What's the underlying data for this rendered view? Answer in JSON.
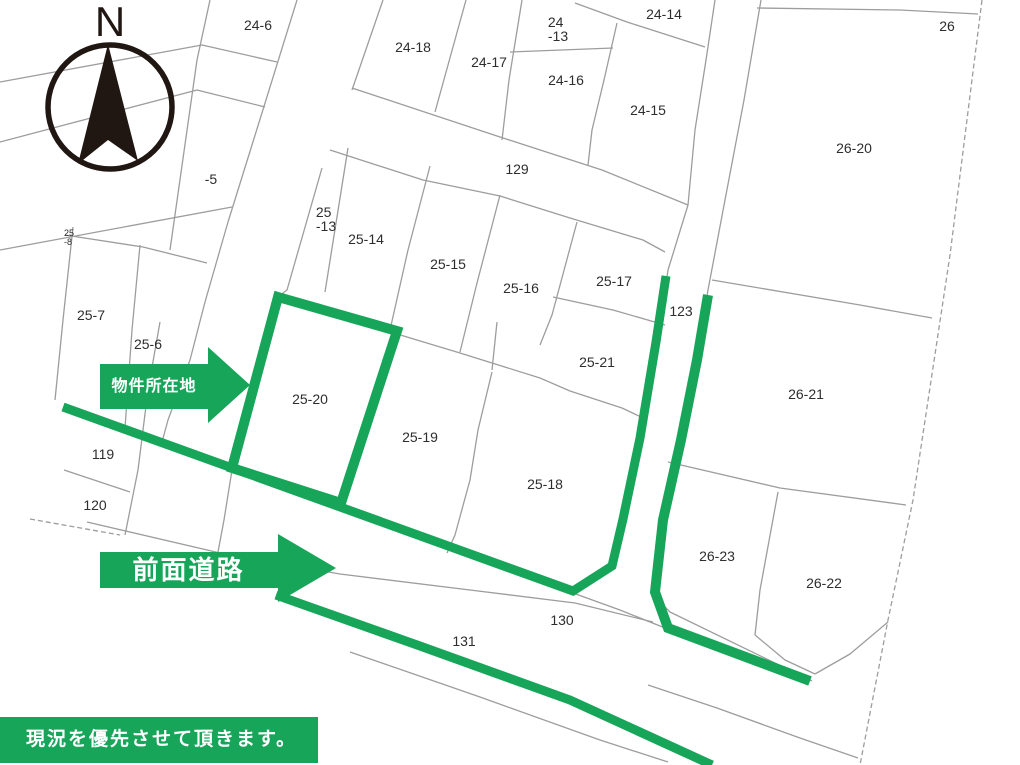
{
  "colors": {
    "highlight_green": "#17a559",
    "line_gray": "#9d9d9d",
    "label_color": "#2e2e2e",
    "compass_dark": "#201612",
    "background": "#ffffff",
    "annotation_text": "#ffffff"
  },
  "compass": {
    "label": "N"
  },
  "annotations": {
    "property_location": "物件所在地",
    "front_road": "前面道路",
    "note": "現況を優先させて頂きます。"
  },
  "parcel_labels": [
    {
      "t": "24-6",
      "x": 258,
      "y": 25
    },
    {
      "t": "24-14",
      "x": 664,
      "y": 14
    },
    {
      "t": "24\n-13",
      "x": 558,
      "y": 29,
      "align": "left"
    },
    {
      "t": "24-18",
      "x": 413,
      "y": 47
    },
    {
      "t": "24-17",
      "x": 489,
      "y": 62
    },
    {
      "t": "24-16",
      "x": 566,
      "y": 80
    },
    {
      "t": "24-15",
      "x": 648,
      "y": 110
    },
    {
      "t": "26",
      "x": 947,
      "y": 26
    },
    {
      "t": "129",
      "x": 517,
      "y": 169
    },
    {
      "t": "26-20",
      "x": 854,
      "y": 148
    },
    {
      "t": "-5",
      "x": 211,
      "y": 179
    },
    {
      "t": "25\n-13",
      "x": 326,
      "y": 219,
      "align": "left"
    },
    {
      "t": "25-14",
      "x": 366,
      "y": 239
    },
    {
      "t": "25-15",
      "x": 448,
      "y": 264
    },
    {
      "t": "25-16",
      "x": 521,
      "y": 288
    },
    {
      "t": "25-17",
      "x": 614,
      "y": 281
    },
    {
      "t": "123",
      "x": 681,
      "y": 311
    },
    {
      "t": "25\n-8",
      "x": 69,
      "y": 238,
      "fs": 9,
      "align": "left"
    },
    {
      "t": "25-7",
      "x": 91,
      "y": 315
    },
    {
      "t": "25-6",
      "x": 148,
      "y": 344
    },
    {
      "t": "25-21",
      "x": 597,
      "y": 362
    },
    {
      "t": "26-21",
      "x": 806,
      "y": 394
    },
    {
      "t": "25-20",
      "x": 310,
      "y": 399
    },
    {
      "t": "25-19",
      "x": 420,
      "y": 437
    },
    {
      "t": "119",
      "x": 103,
      "y": 454
    },
    {
      "t": "25-18",
      "x": 545,
      "y": 484
    },
    {
      "t": "120",
      "x": 95,
      "y": 505
    },
    {
      "t": "26-23",
      "x": 717,
      "y": 556
    },
    {
      "t": "26-22",
      "x": 824,
      "y": 583
    },
    {
      "t": "130",
      "x": 562,
      "y": 620
    },
    {
      "t": "131",
      "x": 464,
      "y": 641
    }
  ]
}
